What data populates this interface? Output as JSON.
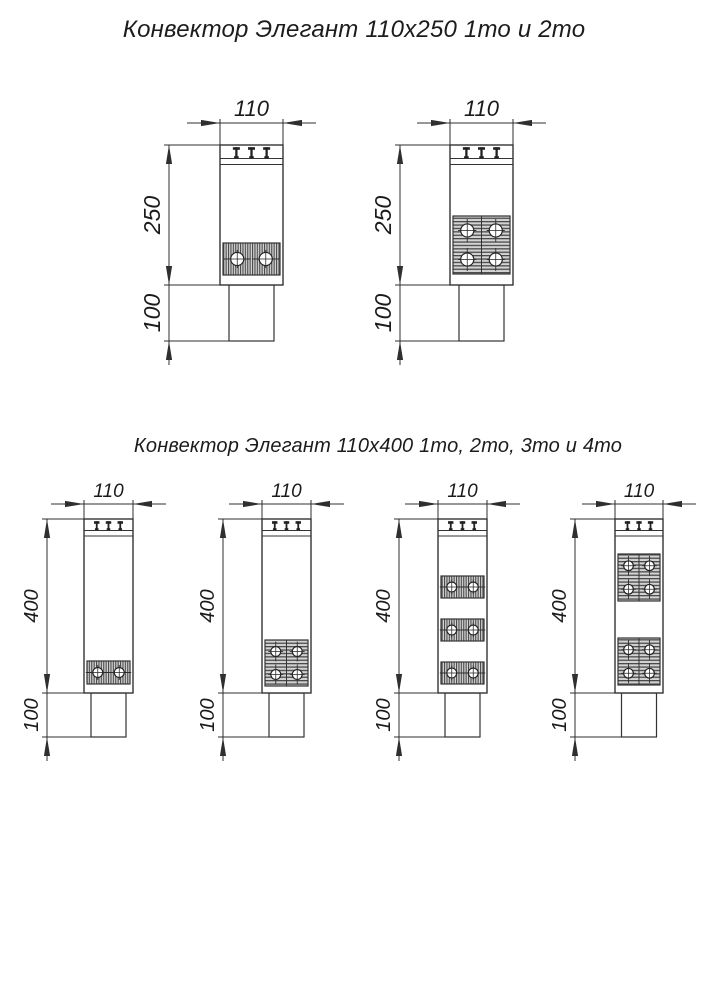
{
  "titles": {
    "top": "Конвектор Элегант 110x250 1то и 2то",
    "bottom": "Конвектор Элегант 110x400 1то, 2то, 3то и 4то"
  },
  "drawing": {
    "background": "#ffffff",
    "outline_color": "#333333",
    "dim_color": "#2f2f2f",
    "text_color": "#1b1b1b",
    "hatch_light": "#d3d3d3",
    "hatch_dark": "#4a4a4a",
    "tube_fill": "#ffffff"
  },
  "diagrams": [
    {
      "name": "110x250-1to",
      "labels": {
        "width": "110",
        "height": "250",
        "base": "100"
      },
      "font_size": 22,
      "body": {
        "left": 220,
        "top": 145,
        "width": 63,
        "height": 140
      },
      "base": {
        "width": 45,
        "height": 56
      },
      "dim_line_x": 169,
      "top_dim_y": 123,
      "grille": [
        13.5,
        19.5
      ],
      "exchangers": [
        {
          "y": 243,
          "height": 32,
          "rows": 1
        }
      ]
    },
    {
      "name": "110x250-2to",
      "labels": {
        "width": "110",
        "height": "250",
        "base": "100"
      },
      "font_size": 22,
      "body": {
        "left": 450,
        "top": 145,
        "width": 63,
        "height": 140
      },
      "base": {
        "width": 45,
        "height": 56
      },
      "dim_line_x": 400,
      "top_dim_y": 123,
      "grille": [
        13.5,
        19.5
      ],
      "exchangers": [
        {
          "y": 216,
          "height": 58,
          "rows": 2
        }
      ]
    },
    {
      "name": "110x400-1to",
      "labels": {
        "width": "110",
        "height": "400",
        "base": "100"
      },
      "font_size": 19,
      "body": {
        "left": 84,
        "top": 519,
        "width": 49,
        "height": 174
      },
      "base": {
        "width": 35,
        "height": 44
      },
      "dim_line_x": 47,
      "top_dim_y": 504,
      "grille": [
        11.5,
        17
      ],
      "exchangers": [
        {
          "y": 661,
          "height": 23,
          "rows": 1
        }
      ]
    },
    {
      "name": "110x400-2to",
      "labels": {
        "width": "110",
        "height": "400",
        "base": "100"
      },
      "font_size": 19,
      "body": {
        "left": 262,
        "top": 519,
        "width": 49,
        "height": 174
      },
      "base": {
        "width": 35,
        "height": 44
      },
      "dim_line_x": 223,
      "top_dim_y": 504,
      "grille": [
        11.5,
        17
      ],
      "exchangers": [
        {
          "y": 640,
          "height": 46,
          "rows": 2
        }
      ]
    },
    {
      "name": "110x400-3to",
      "labels": {
        "width": "110",
        "height": "400",
        "base": "100"
      },
      "font_size": 19,
      "body": {
        "left": 438,
        "top": 519,
        "width": 49,
        "height": 174
      },
      "base": {
        "width": 35,
        "height": 44
      },
      "dim_line_x": 399,
      "top_dim_y": 504,
      "grille": [
        11.5,
        17
      ],
      "exchangers": [
        {
          "y": 576,
          "height": 22,
          "rows": 1
        },
        {
          "y": 619,
          "height": 22,
          "rows": 1
        },
        {
          "y": 662,
          "height": 22,
          "rows": 1
        }
      ]
    },
    {
      "name": "110x400-4to",
      "labels": {
        "width": "110",
        "height": "400",
        "base": "100"
      },
      "font_size": 19,
      "body": {
        "left": 615,
        "top": 519,
        "width": 48,
        "height": 174
      },
      "base": {
        "width": 35,
        "height": 44
      },
      "dim_line_x": 575,
      "top_dim_y": 504,
      "grille": [
        11.5,
        17
      ],
      "exchangers": [
        {
          "y": 554,
          "height": 47,
          "rows": 2
        },
        {
          "y": 638,
          "height": 47,
          "rows": 2
        }
      ]
    }
  ]
}
